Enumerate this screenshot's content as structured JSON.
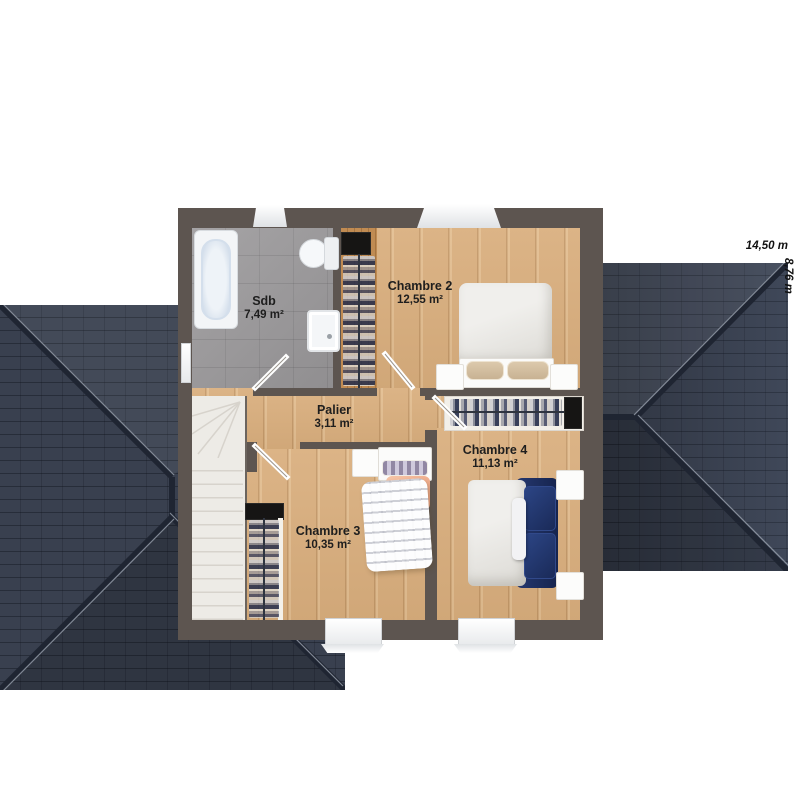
{
  "floorplan": {
    "rooms": [
      {
        "name": "Sdb",
        "area": "7,49 m²"
      },
      {
        "name": "Chambre 2",
        "area": "12,55 m²"
      },
      {
        "name": "Palier",
        "area": "3,11 m²"
      },
      {
        "name": "Chambre 3",
        "area": "10,35 m²"
      },
      {
        "name": "Chambre 4",
        "area": "11,13 m²"
      }
    ],
    "dimensions": {
      "width_label": "14,50 m",
      "depth_label": "8,76 m"
    },
    "colors": {
      "wall": "#5d5550",
      "wood_floor": "#d9ae7d",
      "closet_wood": "#c08b52",
      "bathroom_floor": "#9b999b",
      "roof_slate": "#39404f",
      "bed_navy": "#1c2f62",
      "blanket_salmon": "#f2b697",
      "stairs": "#edebe6"
    }
  }
}
